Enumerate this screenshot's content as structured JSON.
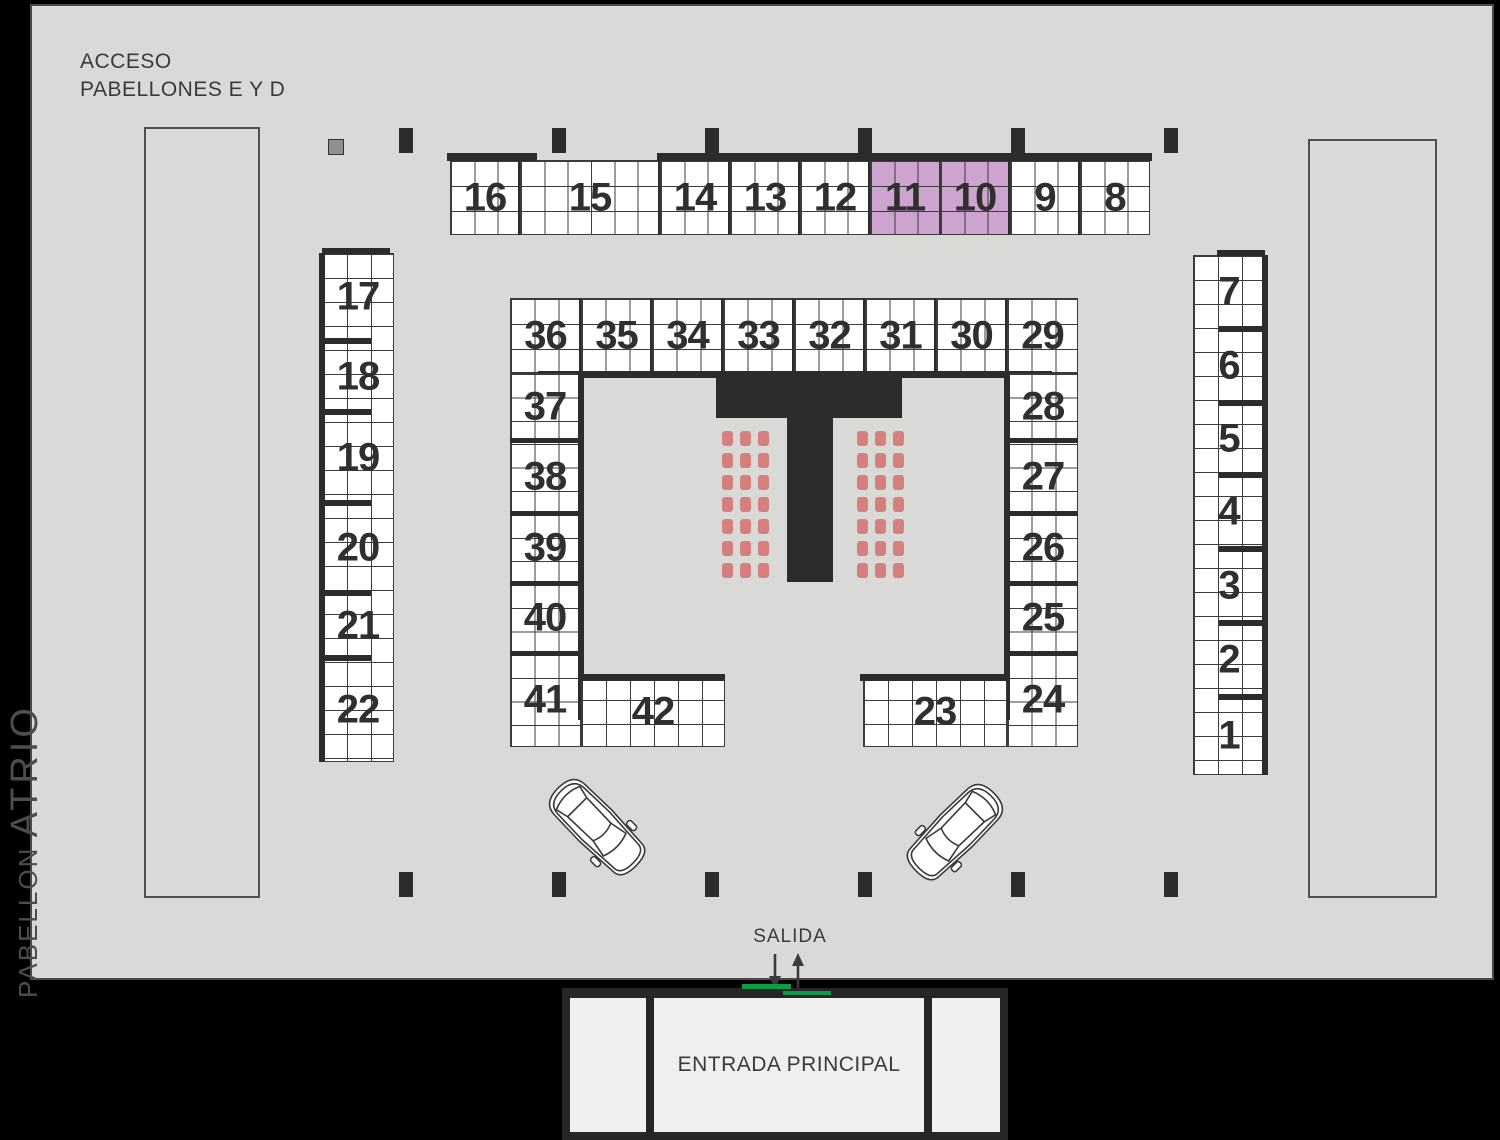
{
  "header": {
    "acceso_line1": "ACCESO",
    "acceso_line2": "PABELLONES E Y D"
  },
  "side_label": {
    "pabellon": "PABELLON",
    "atrio": "ATRIO"
  },
  "bottom": {
    "salida": "SALIDA",
    "entrada": "ENTRADA PRINCIPAL"
  },
  "booths": {
    "top_strip": [
      "16",
      "15",
      "14",
      "13",
      "12",
      "11",
      "10",
      "9",
      "8"
    ],
    "highlighted": [
      "11",
      "10"
    ],
    "outer_left": [
      "17",
      "18",
      "19",
      "20",
      "21",
      "22"
    ],
    "outer_right": [
      "7",
      "6",
      "5",
      "4",
      "3",
      "2",
      "1"
    ],
    "center_top": [
      "36",
      "35",
      "34",
      "33",
      "32",
      "31",
      "30",
      "29"
    ],
    "center_left": [
      "37",
      "38",
      "39",
      "40",
      "41"
    ],
    "center_right": [
      "28",
      "27",
      "26",
      "25",
      "24"
    ],
    "center_bottom_left": [
      "42"
    ],
    "center_bottom_right": [
      "23"
    ]
  },
  "stage": {
    "shape": "T",
    "chair_blocks": 2,
    "chair_rows": 7,
    "chair_cols": 3
  },
  "colors": {
    "background": "#000000",
    "floor": "#d9dad8",
    "line": "#3b3b3b",
    "dark": "#2c2c2c",
    "highlight": "#cda4d0",
    "chair": "#d6807d",
    "green": "#0e9b45",
    "building_interior": "#efefef",
    "number": "#2f2f2f"
  }
}
